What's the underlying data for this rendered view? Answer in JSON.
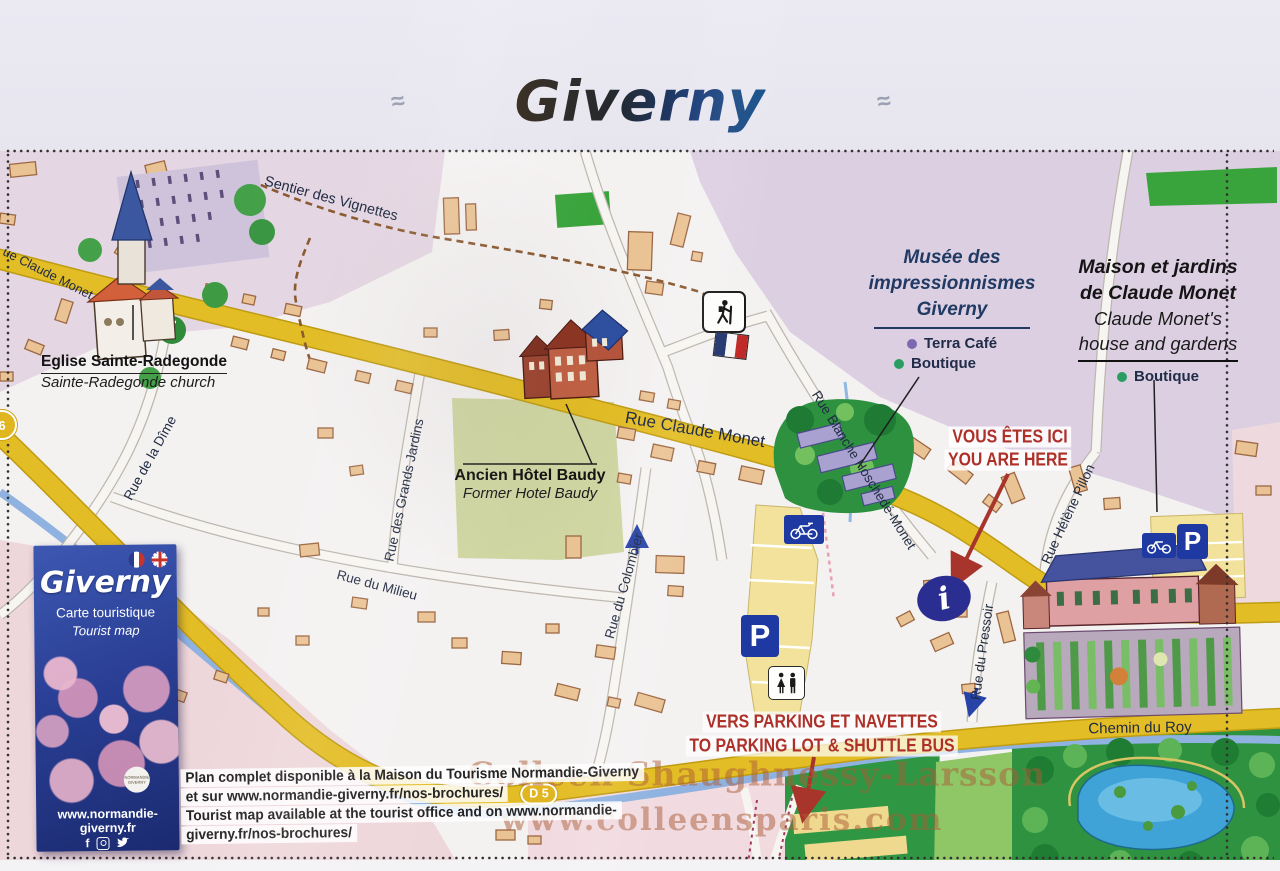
{
  "title": "Giverny",
  "ornament": "≈",
  "streets": {
    "claude_monet_left": "ue Claude Monet",
    "claude_monet": "Rue Claude Monet",
    "sentier_des_vignettes": "Sentier des Vignettes",
    "rue_de_la_dime": "Rue de la Dîme",
    "rue_des_grands_jardins": "Rue des Grands Jardins",
    "rue_du_milieu": "Rue du Milieu",
    "rue_du_colombier": "Rue du Colombier",
    "rue_blanche_hoschede_monet": "Rue Blanche Hoschedé-Monet",
    "rue_helene_pillon": "Rue Hélène Pillon",
    "rue_du_pressoir": "Rue du Pressoir",
    "chemin_du_roy": "Chemin du Roy"
  },
  "badges": {
    "d5": "D 5",
    "route6": "6"
  },
  "landmarks": {
    "eglise": {
      "fr": "Eglise Sainte-Radegonde",
      "en": "Sainte-Radegonde church"
    },
    "baudy": {
      "fr": "Ancien Hôtel Baudy",
      "en": "Former Hotel Baudy"
    },
    "musee": {
      "line1": "Musée des",
      "line2": "impressionnismes",
      "line3": "Giverny",
      "legend": [
        {
          "label": "Terra Café"
        },
        {
          "label": "Boutique"
        }
      ]
    },
    "maison": {
      "fr1": "Maison et jardins",
      "fr2": "de Claude Monet",
      "en1": "Claude Monet's",
      "en2": "house and gardens",
      "legend": [
        {
          "label": "Boutique"
        }
      ]
    }
  },
  "annotations": {
    "here_fr": "VOUS ÊTES ICI",
    "here_en": "YOU ARE HERE",
    "parking_fr": "VERS PARKING ET NAVETTES",
    "parking_en": "TO PARKING LOT & SHUTTLE BUS"
  },
  "icons": {
    "parking": "P",
    "info": "i"
  },
  "brochure": {
    "title": "Giverny",
    "subtitle_fr": "Carte touristique",
    "subtitle_en": "Tourist map",
    "logo": "NORMANDIE GIVERNY",
    "website": "www.normandie-giverny.fr"
  },
  "footer": {
    "line1": "Plan complet disponible à la Maison du Tourisme Normandie-Giverny",
    "line2": "et sur www.normandie-giverny.fr/nos-brochures/",
    "line3": "Tourist map available at the tourist office and on www.normandie-",
    "line4": "giverny.fr/nos-brochures/"
  },
  "watermark": {
    "line1": "Colleen Shaughnessy-Larsson",
    "line2": "www.colleensparis.com"
  },
  "colors": {
    "road_yellow": "#e3bd25",
    "red_annotation": "#ad3029",
    "navy_text": "#203a63",
    "terra_cafe_dot": "#7b68b0",
    "boutique_dot": "#2a9e62",
    "info_blue": "#2b2e91"
  }
}
